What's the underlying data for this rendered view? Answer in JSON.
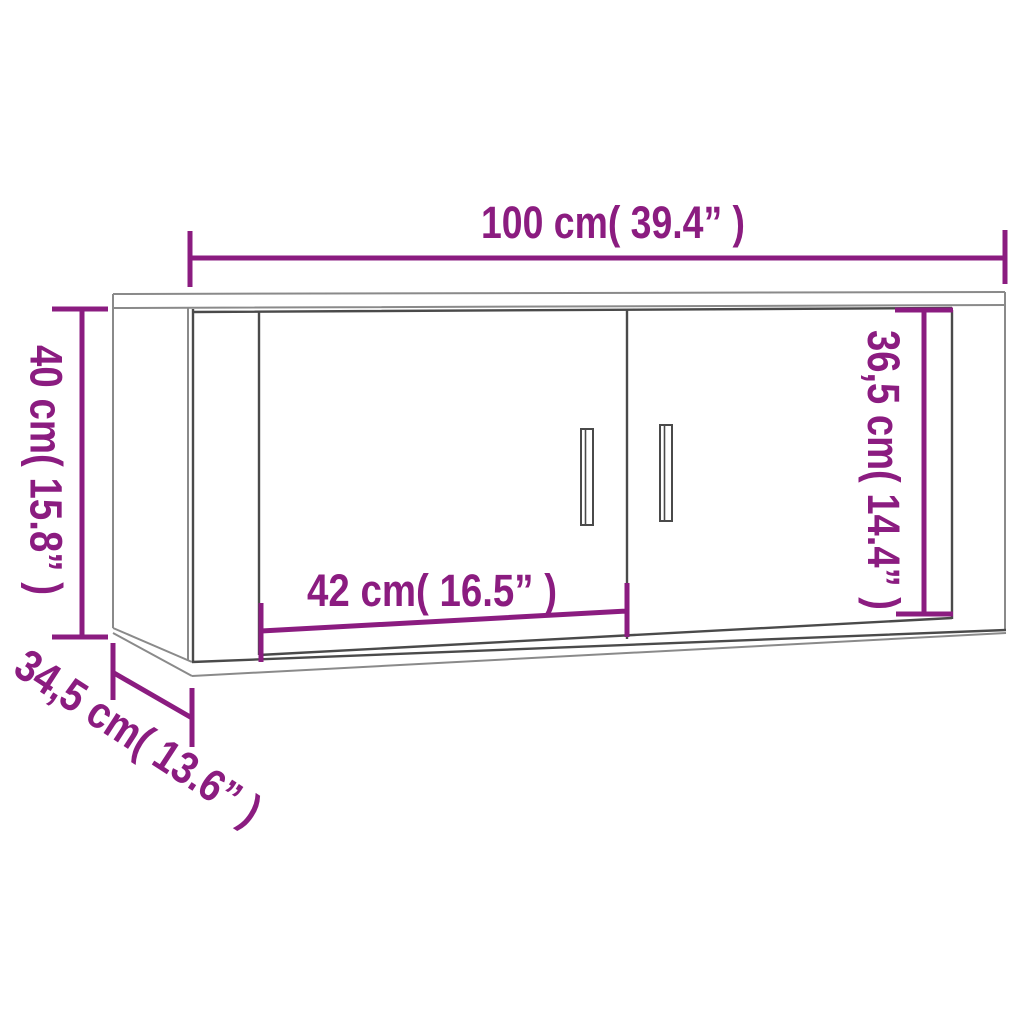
{
  "diagram": {
    "type": "furniture-dimension-diagram",
    "subject": "wall-mounted TV cabinet with two doors, perspective line drawing",
    "background": "#ffffff",
    "colors": {
      "dimension": "#8B1C80",
      "outline_light": "#8a8a8a",
      "outline_dark": "#4a4a4a"
    },
    "dimensions": [
      {
        "id": "overall-width",
        "label": "100 cm( 39.4” )",
        "cm": "100",
        "inches": "39.4",
        "orientation": "horizontal-top"
      },
      {
        "id": "overall-height",
        "label": "40 cm( 15.8” )",
        "cm": "40",
        "inches": "15.8",
        "orientation": "vertical-left"
      },
      {
        "id": "door-height",
        "label": "36,5 cm( 14.4” )",
        "cm": "36,5",
        "inches": "14.4",
        "orientation": "vertical-right-inner"
      },
      {
        "id": "door-width",
        "label": "42 cm( 16.5” )",
        "cm": "42",
        "inches": "16.5",
        "orientation": "horizontal-inner"
      },
      {
        "id": "overall-depth",
        "label": "34,5 cm( 13.6” )",
        "cm": "34,5",
        "inches": "13.6",
        "orientation": "diagonal-bottom-left"
      }
    ]
  }
}
